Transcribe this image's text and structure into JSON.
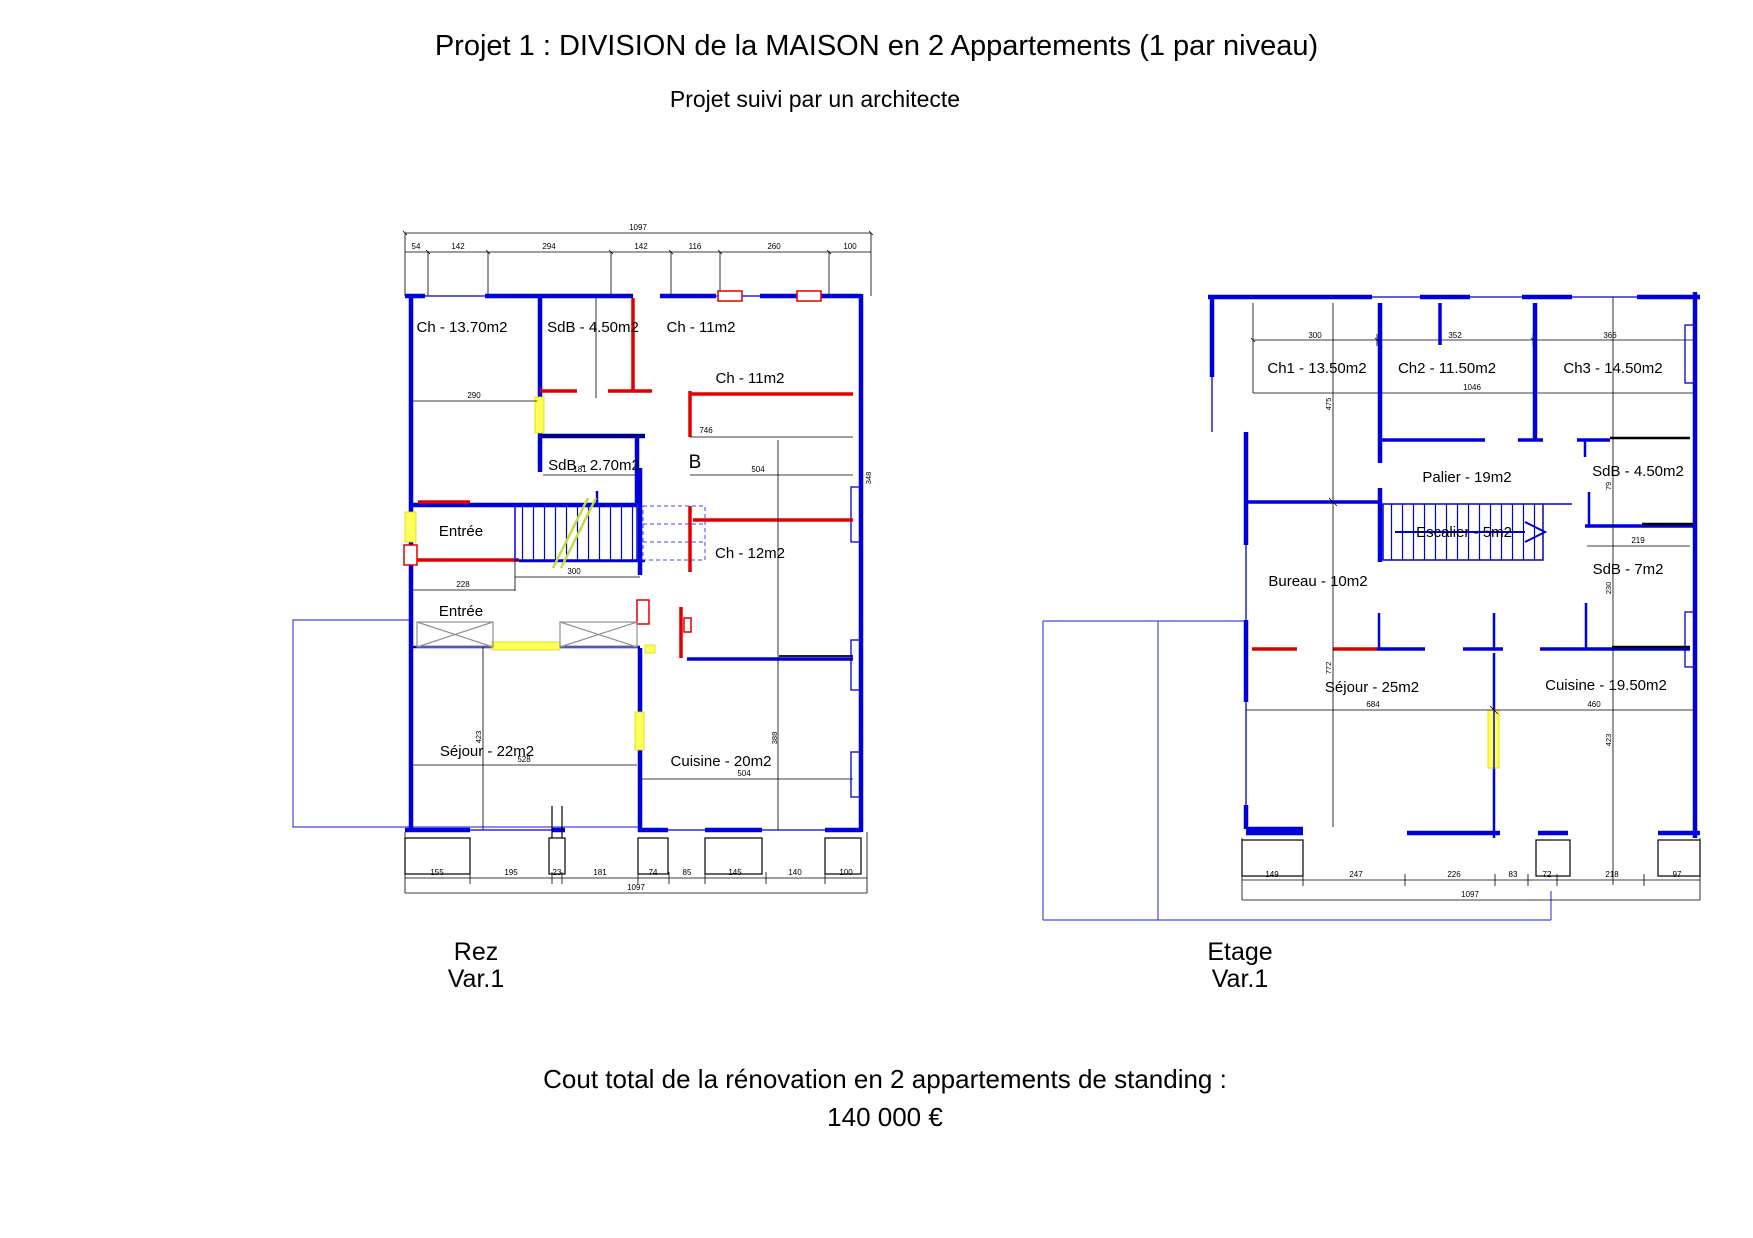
{
  "page": {
    "title": "Projet 1 : DIVISION de la MAISON en 2 Appartements (1 par niveau)",
    "subtitle": "Projet suivi par un architecte",
    "cost_line1": "Cout total de la rénovation en 2 appartements de standing :",
    "cost_line2": "140 000 €"
  },
  "colors": {
    "wall_existing_blue": "#0000DC",
    "wall_dark_navy": "#00008B",
    "wall_new_red": "#E00000",
    "opening_yellow": "#FFFF5A",
    "stair_slash_green": "#C3DC3C",
    "boundary_blue": "#4646F0",
    "demolition_gray": "#909090",
    "dimension_black": "#000000"
  },
  "rez": {
    "caption": [
      "Rez",
      "Var.1"
    ],
    "section_label": "B",
    "rooms": {
      "ch1": "Ch - 13.70m2",
      "sdb1": "SdB - 4.50m2",
      "ch2": "Ch - 11m2",
      "ch3": "Ch - 11m2",
      "sdb2": "SdB - 2.70m2",
      "entree1": "Entrée",
      "ch4": "Ch - 12m2",
      "entree2": "Entrée",
      "sejour": "Séjour - 22m2",
      "cuisine": "Cuisine - 20m2"
    },
    "dims": {
      "top_total": "1097",
      "top": [
        "54",
        "142",
        "294",
        "142",
        "116",
        "260",
        "100"
      ],
      "bottom": [
        "155",
        "195",
        "23",
        "181",
        "74",
        "85",
        "145",
        "140",
        "100"
      ],
      "bottom_total": "1097",
      "d290": "290",
      "d181": "181",
      "d746": "746",
      "d504a": "504",
      "d348": "348",
      "d300": "300",
      "d228": "228",
      "d528": "528",
      "d423": "423",
      "d504b": "504",
      "d388": "388"
    }
  },
  "etage": {
    "caption": [
      "Etage",
      "Var.1"
    ],
    "rooms": {
      "ch1": "Ch1 - 13.50m2",
      "ch2": "Ch2 - 11.50m2",
      "ch3": "Ch3 - 14.50m2",
      "palier": "Palier - 19m2",
      "escalier": "Escalier - 5m2",
      "sdb1": "SdB - 4.50m2",
      "sdb2": "SdB - 7m2",
      "bureau": "Bureau - 10m2",
      "sejour": "Séjour - 25m2",
      "cuisine": "Cuisine - 19.50m2"
    },
    "dims": {
      "top": [
        "300",
        "352",
        "366"
      ],
      "width_total": "1046",
      "bottom": [
        "149",
        "247",
        "226",
        "83",
        "72",
        "218",
        "97"
      ],
      "bottom_total": "1097",
      "d475": "475",
      "d772": "772",
      "d79": "79",
      "d230": "230",
      "d423": "423",
      "d219": "219",
      "d684": "684",
      "d460": "460"
    }
  }
}
